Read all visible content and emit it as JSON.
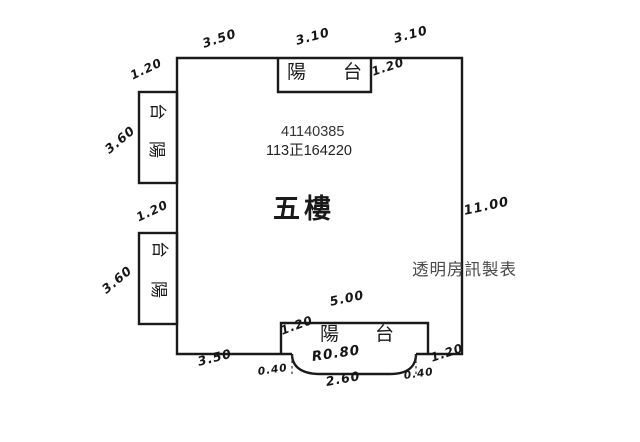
{
  "page": {
    "background": "#ffffff",
    "line_color": "#1a1a1a",
    "watermark_color": "#4a4a4a"
  },
  "unit": {
    "serial": "41140385",
    "case_number": "113正164220",
    "floor_label": "五樓",
    "watermark": "透明房訊製表"
  },
  "balconies": {
    "top": {
      "char1": "陽",
      "char2": "台"
    },
    "left_upper": {
      "char_top": "台",
      "char_bottom": "陽"
    },
    "left_lower": {
      "char_top": "台",
      "char_bottom": "陽"
    },
    "bottom": {
      "char1": "陽",
      "char2": "台"
    }
  },
  "dimensions": {
    "top_left_wall": "3.50",
    "top_balcony_width": "3.10",
    "top_right_wall": "3.10",
    "top_balcony_depth": "1.20",
    "left_upper_balcony_depth": "1.20",
    "left_upper_balcony_length": "3.60",
    "left_lower_balcony_depth": "1.20",
    "left_lower_balcony_length": "3.60",
    "right_wall": "11.00",
    "bottom_left_wall": "3.50",
    "bottom_balcony_width": "5.00",
    "bottom_balcony_left_depth": "1.20",
    "bottom_balcony_right_depth": "1.20",
    "arc_radius": "R0.80",
    "arc_width": "2.60",
    "arc_left_offset": "0.40",
    "arc_right_offset": "0.40"
  }
}
